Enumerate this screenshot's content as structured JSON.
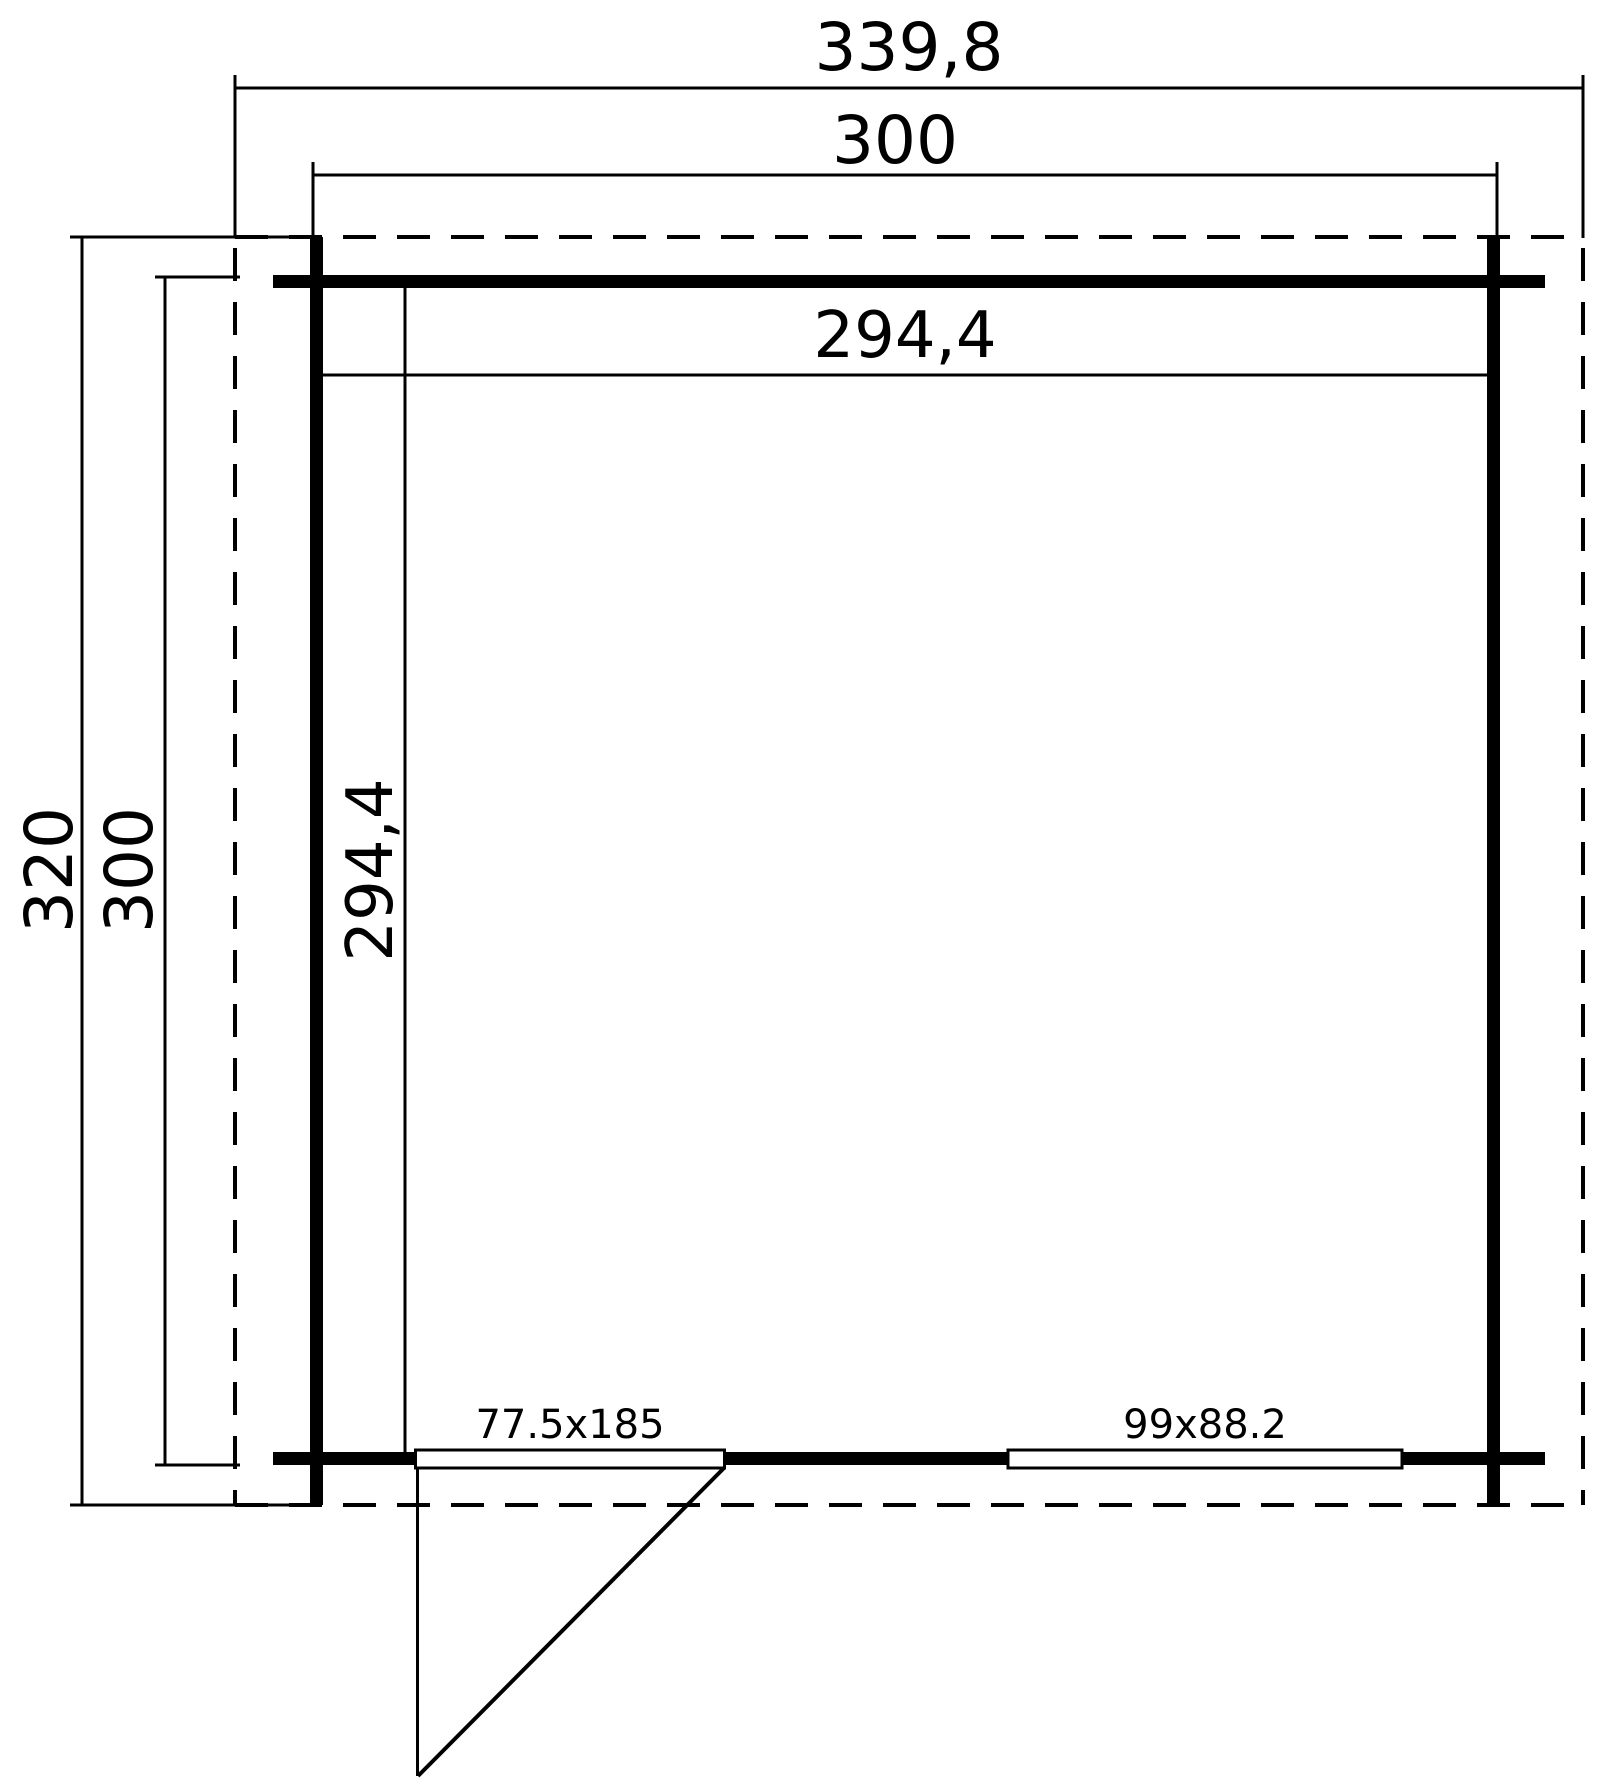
{
  "drawing": {
    "kind": "floor-plan",
    "background_color": "#ffffff",
    "line_color": "#000000"
  },
  "dimensions": {
    "roof_width": "339,8",
    "building_width": "300",
    "inner_width": "294,4",
    "roof_depth": "320",
    "building_depth": "300",
    "inner_depth": "294,4"
  },
  "openings": {
    "door_label": "77.5x185",
    "window_label": "99x88.2"
  }
}
